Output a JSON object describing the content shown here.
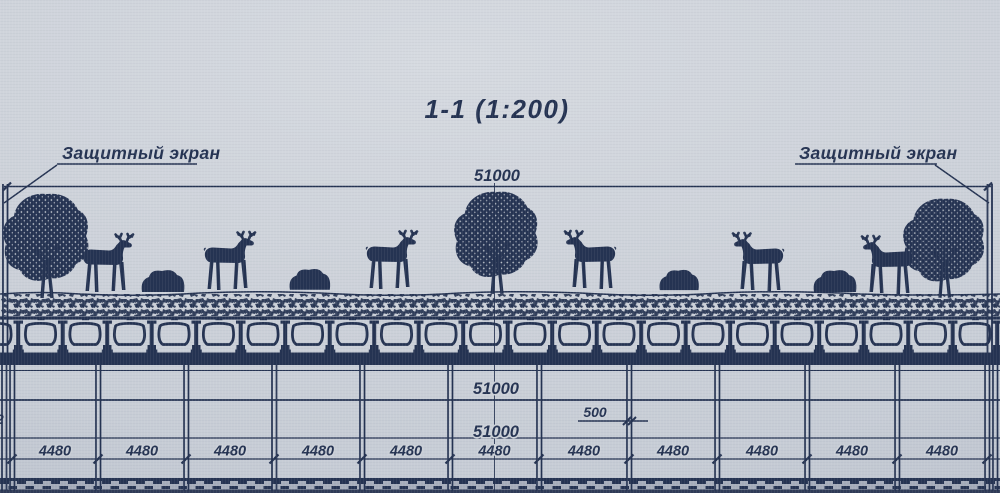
{
  "colors": {
    "ink": "#253352",
    "paper": "#cdd2d9",
    "ground_band": "#a8afbd",
    "ground_dark": "#2f3b57"
  },
  "title": "1-1 (1:200)",
  "screen_labels": {
    "left": "Защитный экран",
    "right": "Защитный экран"
  },
  "dims": {
    "top_span": "51000",
    "mid_upper": "51000",
    "mid_lower": "51000",
    "pier_width": "500",
    "edge_clipped": "2",
    "bays": [
      "4480",
      "4480",
      "4480",
      "4480",
      "4480",
      "4480",
      "4480",
      "4480",
      "4480",
      "4480",
      "4480"
    ]
  },
  "scene": {
    "deer_count": 6,
    "tree_count": 3,
    "bush_count": 4
  }
}
